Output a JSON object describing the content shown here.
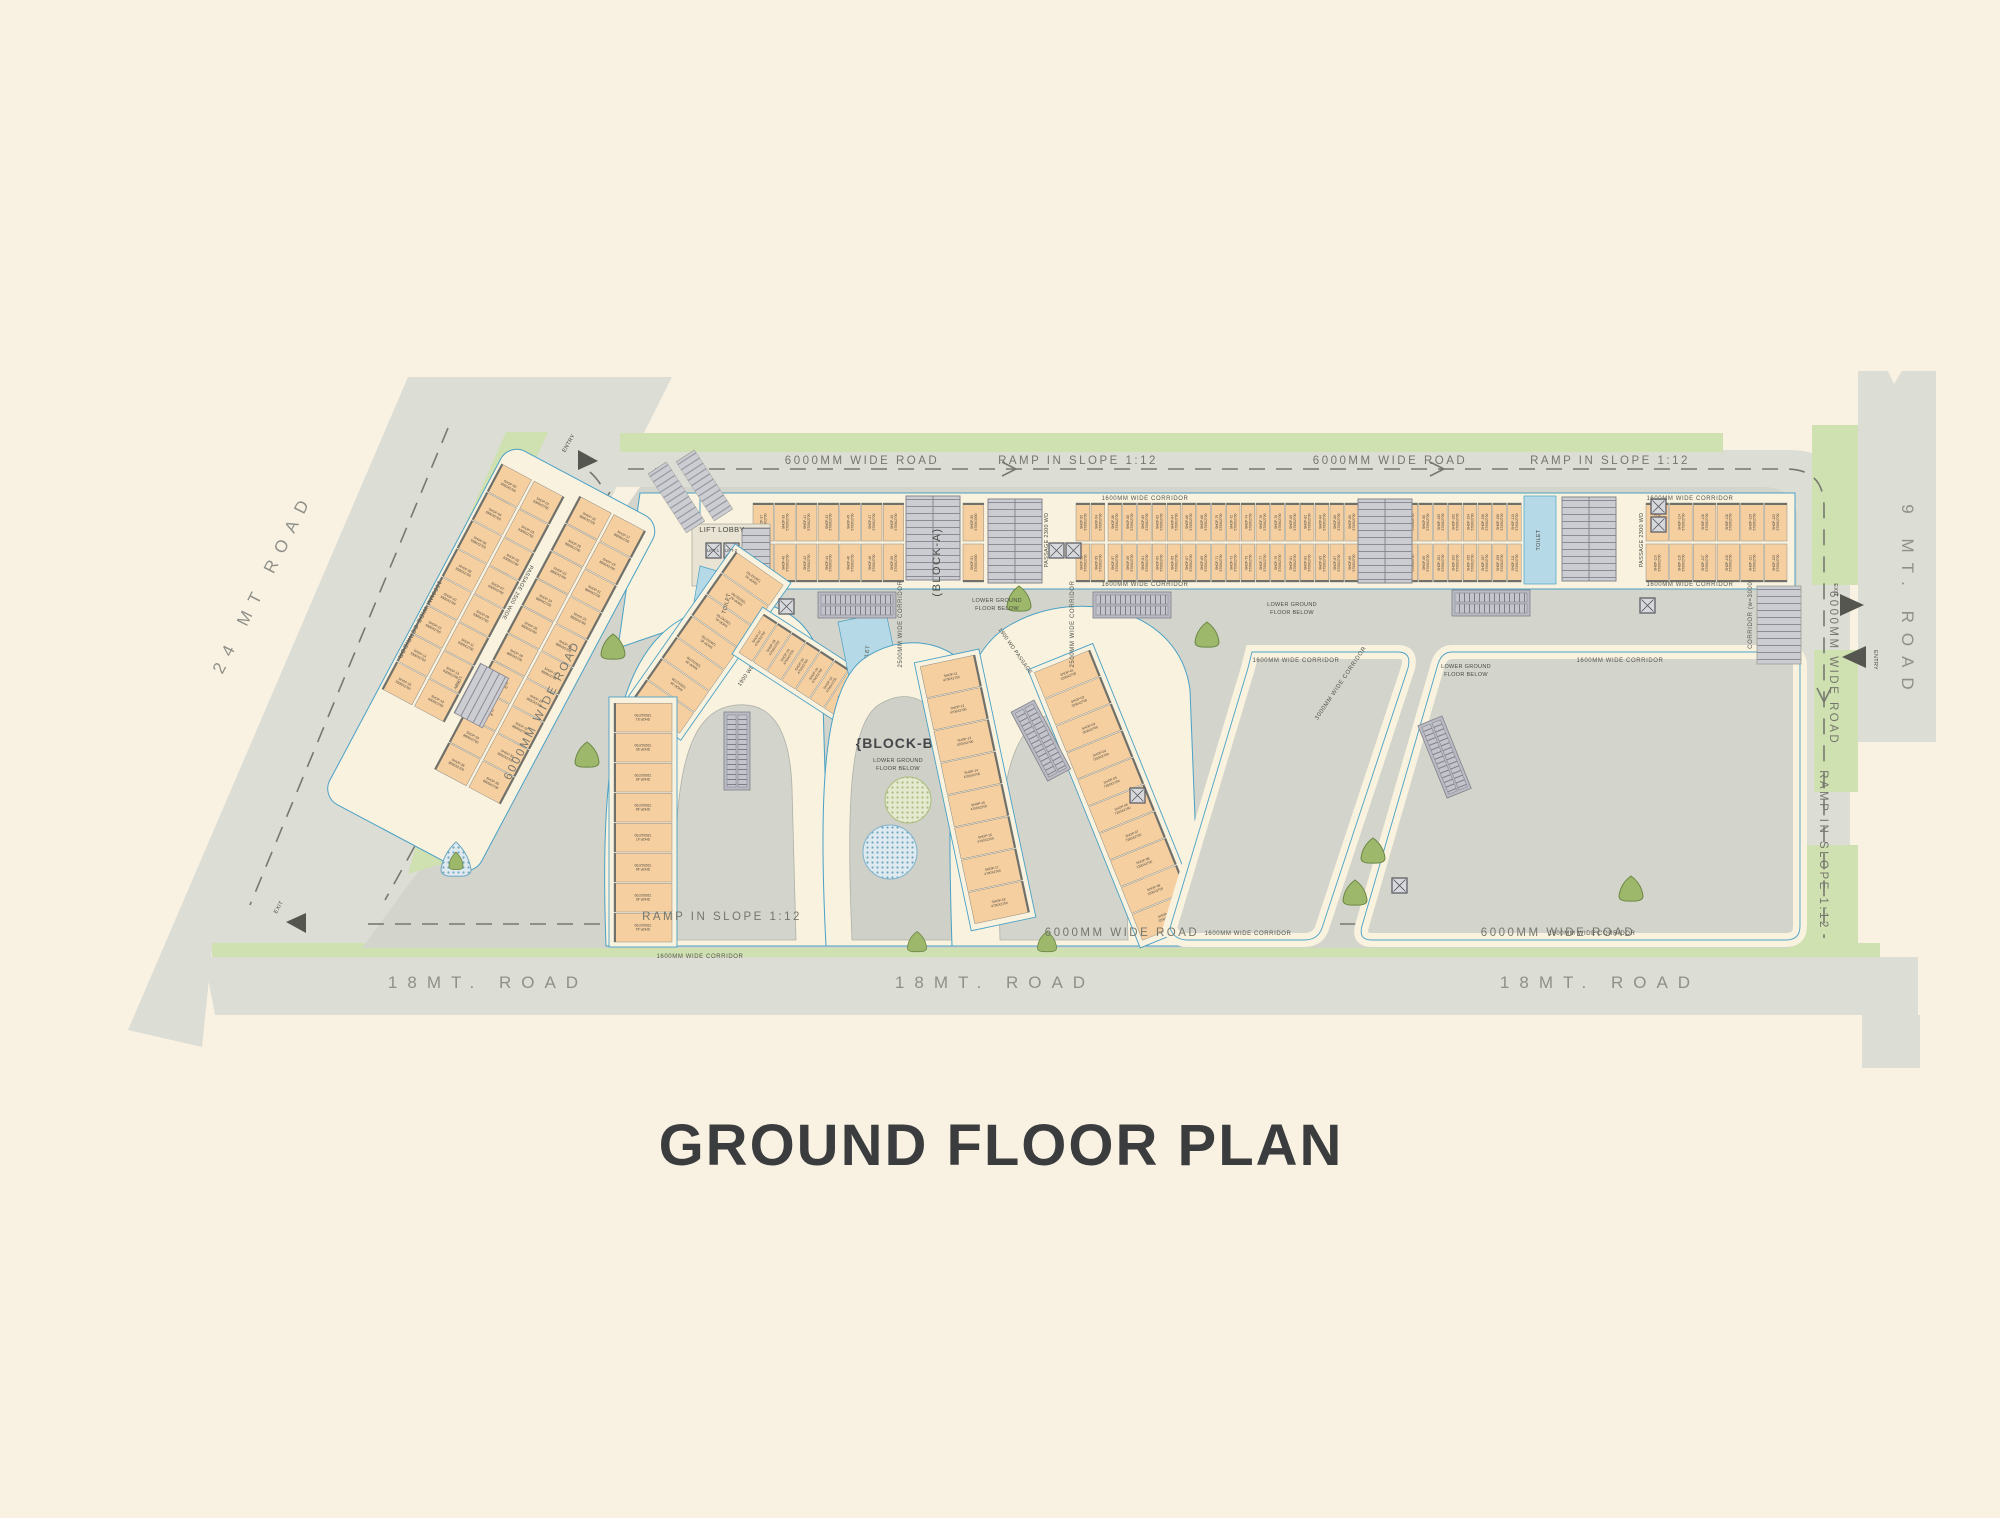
{
  "title": "GROUND FLOOR PLAN",
  "roads": {
    "r24": "24 MT ROAD",
    "r18a": "18MT. ROAD",
    "r18b": "18MT. ROAD",
    "r18c": "18MT. ROAD",
    "r9": "9 MT. ROAD",
    "wide": "6000MM WIDE ROAD",
    "ramp": "RAMP IN SLOPE  1:12",
    "entry": "ENTRY",
    "exit": "EXIT"
  },
  "plan": {
    "blockA": "(BLOCK-A)",
    "blockB": "{BLOCK-B}",
    "liftLobby": "LIFT LOBBY",
    "toilet": "TOILET",
    "lift1": "LIFT-1",
    "lift2": "LIFT-2",
    "lift": "LIFT",
    "lobby": "LOBBY",
    "lowerGround": "LOWER GROUND",
    "floorBelow": "FLOOR BELOW",
    "c1600": "1600MM WIDE CORRIDOR",
    "c2500": "2500MM WIDE CORRIDOR",
    "c3000": "3000MM WIDE CORRIDOR",
    "corr3000": "CORRIDOR (w=3000)",
    "p2300": "PASSAGE 2300 WD",
    "p2500": "PASSAGE 2500 WIDE",
    "p1900": "1900 WD PASSAGE"
  },
  "strips": [
    {
      "name": "blockA-left-group",
      "prefix": "SHOP-",
      "from": 37,
      "cols": 7,
      "rows": 2,
      "cw": 21.7,
      "ch": 38,
      "dim": "5700X2700",
      "bg": false
    },
    {
      "name": "blockA-col50",
      "prefix": "SHOP-",
      "from": 50,
      "cols": 1,
      "rows": 2,
      "cw": 22,
      "ch": 38,
      "dim": "5700X3000",
      "bg": false
    },
    {
      "name": "blockA-col52",
      "prefix": "SHOP-",
      "from": 52,
      "cols": 2,
      "rows": 2,
      "cw": 15,
      "ch": 38,
      "dim": "5700X2700",
      "bg": false
    },
    {
      "name": "blockA-main-run",
      "prefix": "SHOP-",
      "from": 56,
      "cols": 28,
      "rows": 2,
      "cw": 14.8,
      "ch": 38,
      "dim": "5700X2700",
      "bg": false
    },
    {
      "name": "blockA-right-group",
      "prefix": "SHOP-",
      "from": 112,
      "cols": 6,
      "rows": 2,
      "cw": 23.7,
      "ch": 38,
      "dim": "5700X2700",
      "bg": false
    },
    {
      "name": "wing-upper",
      "prefix": "SHOP-",
      "from": 17,
      "cols": 10,
      "rows": 2,
      "cw": 31,
      "ch": 36,
      "dim": "8600X2700",
      "bg": false
    },
    {
      "name": "wing-lower",
      "prefix": "SHOP-",
      "from": 1,
      "cols": 8,
      "rows": 2,
      "cw": 32,
      "ch": 34,
      "dim": "9300X2700",
      "bg": false
    },
    {
      "name": "archL-top",
      "prefix": "SHOP-",
      "from": 37,
      "cols": 7,
      "rows": 1,
      "cw": 26,
      "ch": 58,
      "dim": "7200X2700",
      "bg": true
    },
    {
      "name": "archL-limb",
      "prefix": "SHOP-",
      "from": 44,
      "cols": 8,
      "rows": 1,
      "cw": 30,
      "ch": 58,
      "dim": "7200X2700",
      "bg": true
    },
    {
      "name": "ring-left",
      "prefix": "SHOP-",
      "from": 27,
      "cols": 9,
      "rows": 1,
      "cw": 17,
      "ch": 46,
      "dim": "4750X2700",
      "bg": true
    },
    {
      "name": "ring-right",
      "prefix": "SHOP-",
      "from": 19,
      "cols": 8,
      "rows": 1,
      "cw": 17,
      "ch": 46,
      "dim": "4750X2700",
      "bg": true
    },
    {
      "name": "archR-limb-left",
      "prefix": "SHOP-",
      "from": 11,
      "cols": 8,
      "rows": 1,
      "cw": 33,
      "ch": 56,
      "dim": "4700X2700",
      "bg": true
    },
    {
      "name": "archR-limb-right",
      "prefix": "SHOP-",
      "from": 1,
      "cols": 10,
      "rows": 1,
      "cw": 29,
      "ch": 60,
      "dim": "7200X2700",
      "bg": true
    }
  ],
  "colors": {
    "bg": "#f9f2e3",
    "road": "#dcddd5",
    "site": "#d3d4cb",
    "green": "#cfe0b1",
    "cream": "#f8f2df",
    "shop": "#f6cfa0",
    "blue": "#4aa1c6",
    "toiletBlue": "#b5d9e6",
    "title": "#3b3c3e"
  }
}
